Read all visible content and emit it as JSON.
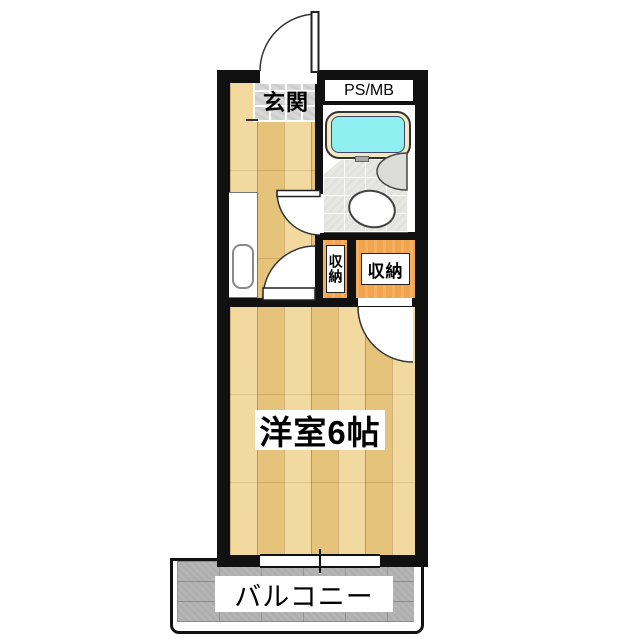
{
  "plan": {
    "type": "japanese-apartment-floor-plan",
    "rooms": {
      "genkan": {
        "label": "玄関"
      },
      "ps_mb": {
        "label": "PS/MB"
      },
      "closet_left": {
        "label": "収納"
      },
      "closet_right": {
        "label": "収納"
      },
      "main_room": {
        "label": "洋室6帖"
      },
      "balcony": {
        "label": "バルコニー"
      }
    },
    "fixtures": [
      "entrance-door",
      "bathtub",
      "wash-basin",
      "toilet",
      "kitchen-sink",
      "closet-door",
      "room-door",
      "sliding-window"
    ]
  },
  "colors": {
    "wall": "#111111",
    "wood": "#efce85",
    "genkan_tile": "#d8d8d8",
    "bath_floor": "#e7e7e3",
    "tub_water": "#8feff0",
    "tub_rim": "#efe8c2",
    "closet_orange": "#f1a44c",
    "balcony_deck": "#afafaf",
    "label_bg": "#ffffff",
    "text": "#000000"
  }
}
